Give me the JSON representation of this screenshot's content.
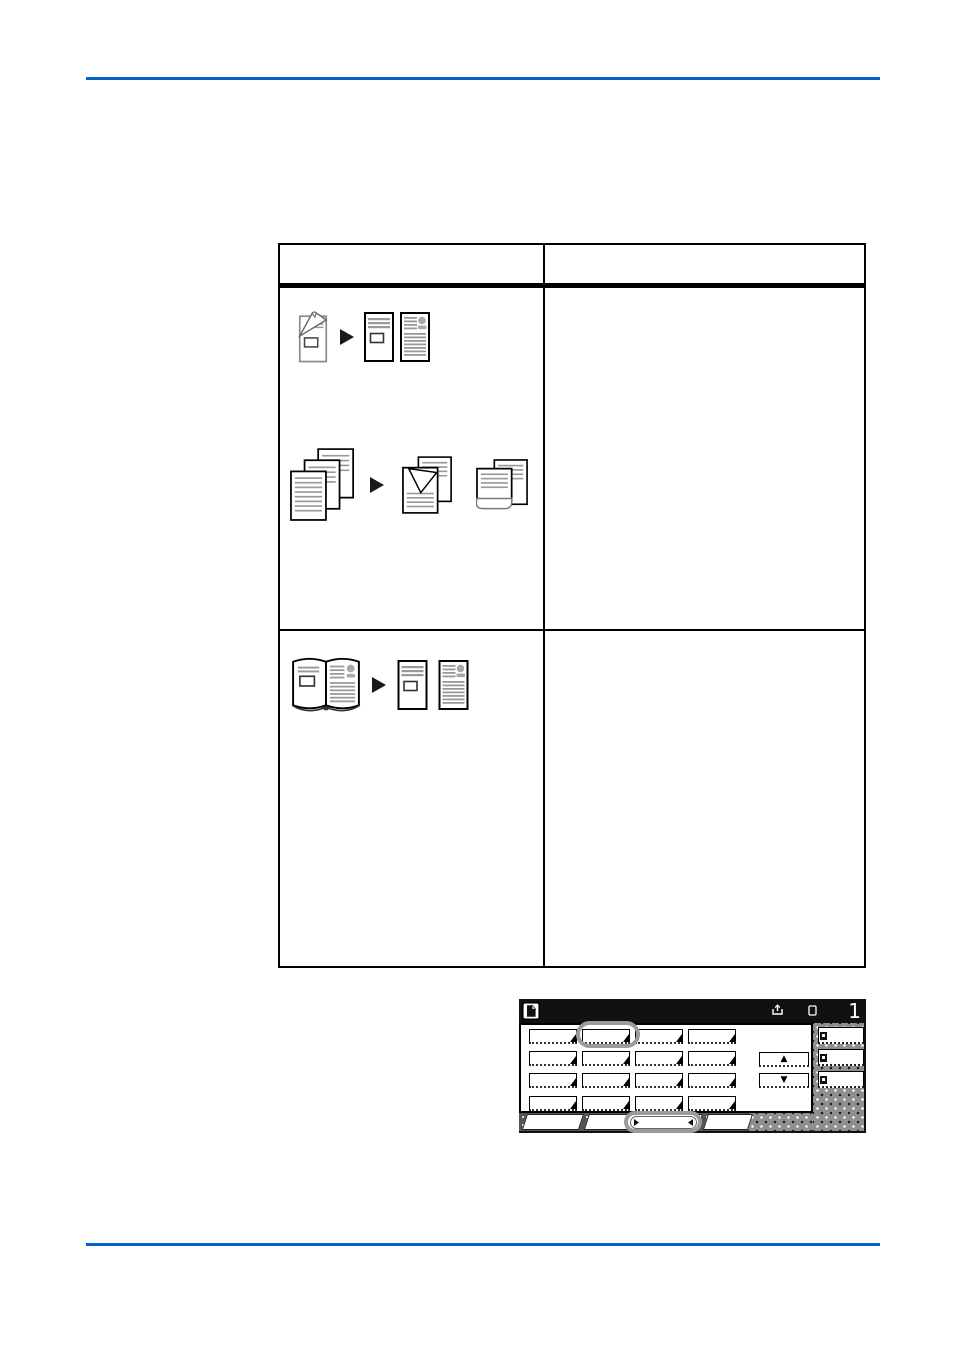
{
  "rules": {
    "color": "#0562C1"
  },
  "table": {
    "row1_example_a_icons": [
      "two-sided-original-icon",
      "arrow-right-icon",
      "copy-page-text-icon",
      "copy-page-portrait-icon"
    ],
    "row1_example_b_icons": [
      "original-stack-icon",
      "arrow-right-icon",
      "copies-folded-corner-icon",
      "copies-curled-icon"
    ],
    "row2_example_icons": [
      "open-book-original-icon",
      "arrow-right-icon",
      "copy-page-text-icon",
      "copy-page-portrait-icon"
    ]
  },
  "panel": {
    "status_value": "1",
    "title_icons": [
      "document-icon",
      "output-tray-icon",
      "paper-icon"
    ],
    "grid_button_count": 16,
    "scroll_up": "▲",
    "scroll_down": "▼",
    "side_button_count": 3,
    "tab_count": 3,
    "annotation_color": "#9b9b9b",
    "halftone_color": "#8f8f8f"
  }
}
